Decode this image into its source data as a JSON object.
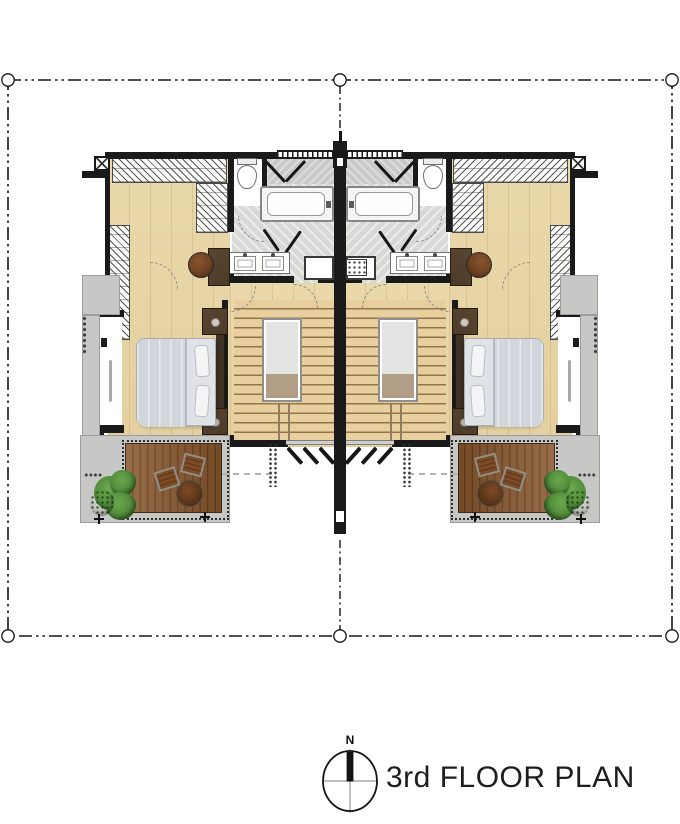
{
  "title": {
    "label": "3rd FLOOR PLAN"
  },
  "compass": {
    "north_label": "N"
  },
  "colors": {
    "wall": "#1a1a1a",
    "wood-floor": "#ead9ab",
    "bath-floor": "#d8d8d6",
    "shower-floor": "#c9c9c7",
    "concrete": "#c7c7c5",
    "deck-wood": "#8a5a31",
    "deck-groove": "#6b4120",
    "stair-wood": "#e7cf9e",
    "stair-nosing": "#93744c",
    "void-fill": "#e3e3e1",
    "void-landing": "#b09e86",
    "bed-linen": "#dfe3e8",
    "blanket": "#d0d6dc",
    "pillow": "#f3f4f6",
    "dark-wood": "#4c3a28",
    "stool-wood": "#6f4023",
    "plant-green": "#4f8a39",
    "plant-shade": "#2c5a1e",
    "boundary-line": "#161616"
  }
}
